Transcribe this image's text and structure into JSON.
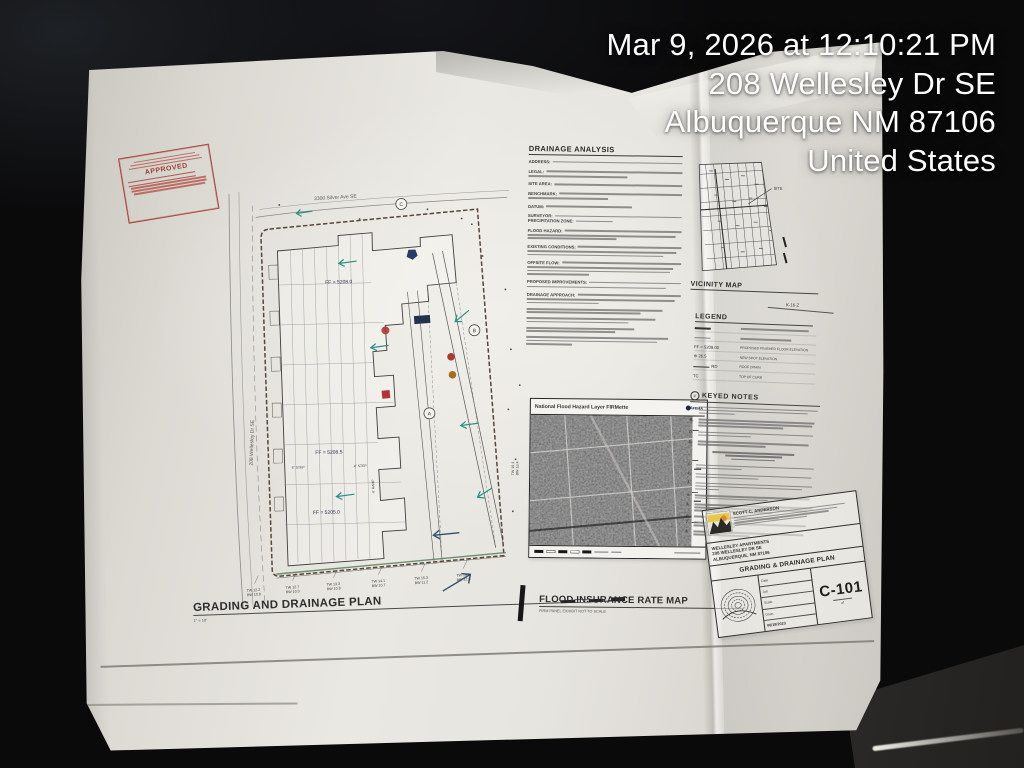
{
  "overlay": {
    "lines": [
      "Mar 9, 2026 at 12:10:21 PM",
      "208 Wellesley Dr SE",
      "Albuquerque NM 87106",
      "United States"
    ]
  },
  "stamp": {
    "title": "APPROVED"
  },
  "site_plan": {
    "title": "GRADING AND DRAINAGE PLAN",
    "scale_note": "1\" = 10'",
    "street_top": "3300 Silver Ave SE",
    "street_left": "208 Wellesley Dr SE",
    "ff_labels": [
      "FF = 5208.0",
      "FF = 5208.5",
      "FF = 5205.0"
    ],
    "step_labels": [
      "6\" STEP",
      "4\" STEP",
      "6' RAMP"
    ],
    "callouts": [
      "C",
      "B",
      "A"
    ],
    "walls": [
      {
        "tw": "TW 12.2",
        "bw": "BW 10.8"
      },
      {
        "tw": "TW 12.7",
        "bw": "BW 10.0"
      },
      {
        "tw": "TW 13.3",
        "bw": "BW 10.8"
      },
      {
        "tw": "TW 14.1",
        "bw": "BW 10.7"
      },
      {
        "tw": "TW 15.3",
        "bw": "BW 11.2"
      },
      {
        "tw": "TW 16.0",
        "bw": "BW 12.0"
      }
    ],
    "wall_right": {
      "tw": "TW 16.3",
      "bw": "BW 13.4"
    }
  },
  "drainage": {
    "title": "DRAINAGE ANALYSIS",
    "labels": [
      "ADDRESS:",
      "LEGAL:",
      "SITE AREA:",
      "BENCHMARK:",
      "DATUM:",
      "SURVEYOR:",
      "PRECIPITATION ZONE:",
      "FLOOD HAZARD:",
      "EXISTING CONDITIONS:",
      "OFFSITE FLOW:",
      "PROPOSED IMPROVEMENTS:",
      "DRAINAGE APPROACH:"
    ]
  },
  "flood": {
    "header": "National Flood Hazard Layer FIRMette",
    "agency": "FEMA",
    "title": "FLOOD INSURANCE RATE MAP",
    "subtitle": "FIRM PANEL EXHIBIT  NOT TO SCALE"
  },
  "vicinity": {
    "title": "VICINITY MAP",
    "grid_ref": "K-16-Z",
    "site_label": "SITE"
  },
  "legend": {
    "title": "LEGEND",
    "rows": [
      {
        "symbol": "FF = 5208.00",
        "desc": "PROPOSED FINISHED FLOOR ELEVATION"
      },
      {
        "symbol": "⊕ 26.5",
        "desc": "NEW SPOT ELEVATION"
      },
      {
        "symbol": "RD",
        "desc": "ROOF DRAIN"
      },
      {
        "symbol": "TC",
        "desc": "TOP OF CURB"
      }
    ]
  },
  "keyed": {
    "title": "KEYED NOTES",
    "letters": [
      "A.",
      "B.",
      "C.",
      "D."
    ],
    "numbers": [
      "1.",
      "2.",
      "3.",
      "4.",
      "5.",
      "6.",
      "7.",
      "8."
    ]
  },
  "title_block": {
    "firm": "SCOTT C. ANDERSON",
    "project": [
      "WELLESLEY APARTMENTS",
      "208 WELLESLEY DR SE",
      "ALBUQUERQUE, NM 87106"
    ],
    "sheet_title": "GRADING & DRAINAGE PLAN",
    "row_labels": [
      "Date",
      "Job",
      "Scale",
      "Drwn"
    ],
    "date": "06/19/2023",
    "number": "C-101",
    "of_label": "of"
  },
  "colors": {
    "paper": "#e9e7e1",
    "ink": "#3f3f3f",
    "flow_arrow": "#2e8f88",
    "stamp_red": "#a8433c",
    "overlay_text": "#ffffff",
    "logo_orange": "#d98a2b",
    "background": "#0a0a0b"
  }
}
